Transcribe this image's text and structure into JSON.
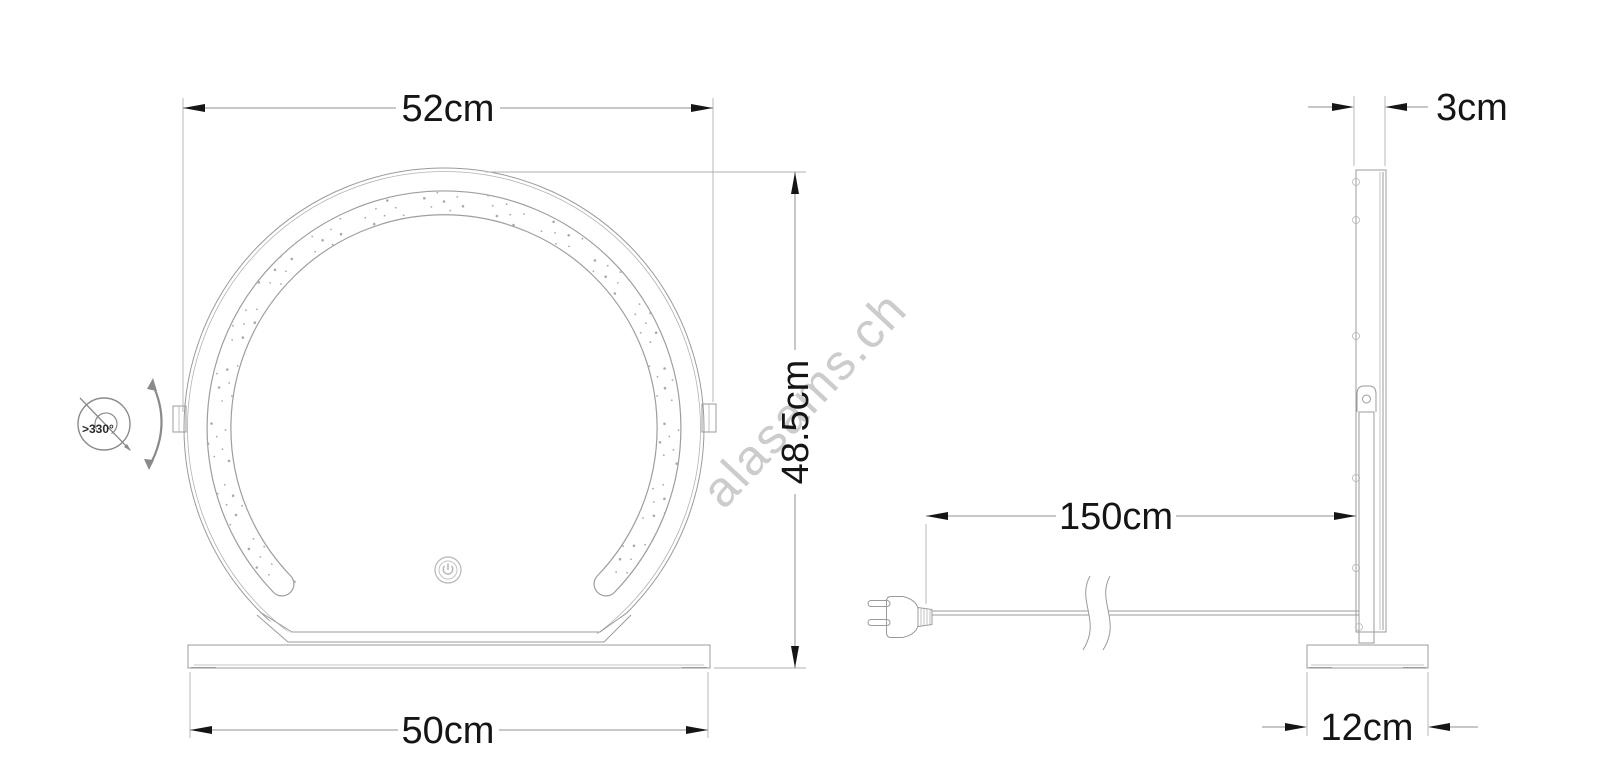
{
  "diagram": {
    "watermark": "alasams.ch",
    "front_view": {
      "width_label": "52cm",
      "height_label": "48.5cm",
      "base_width_label": "50cm",
      "rotation_label": ">330°"
    },
    "side_view": {
      "thickness_label": "3cm",
      "cable_length_label": "150cm",
      "base_depth_label": "12cm"
    }
  }
}
